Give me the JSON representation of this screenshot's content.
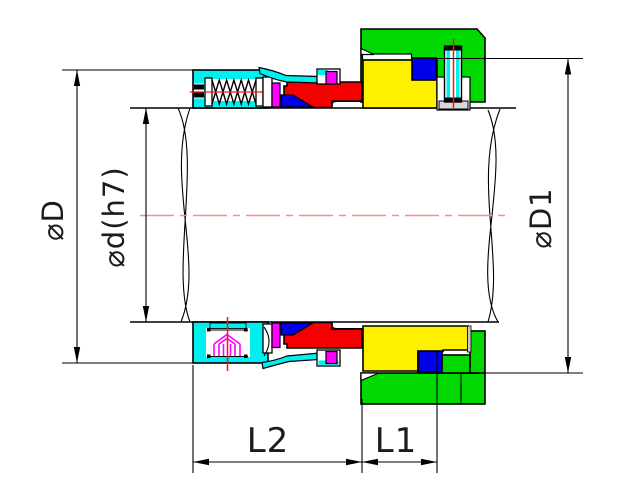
{
  "drawing": {
    "title": "mechanical-seal-cross-section",
    "labels": {
      "dia_housing": "⌀D",
      "dia_shaft": "⌀d(h7)",
      "dia_gland": "⌀D1",
      "len_l2": "L2",
      "len_l1": "L1"
    },
    "colors": {
      "housing_cyan": "#00efef",
      "gland_green": "#00d800",
      "seat_yellow": "#fff000",
      "rotary_red": "#f40000",
      "oring_blue": "#0000e8",
      "elastomer_magenta": "#ff00ff",
      "centerline_salmon": "#ff8a8a",
      "centerline_red": "#ff1010",
      "line_black": "#000000",
      "background": "#ffffff"
    }
  }
}
